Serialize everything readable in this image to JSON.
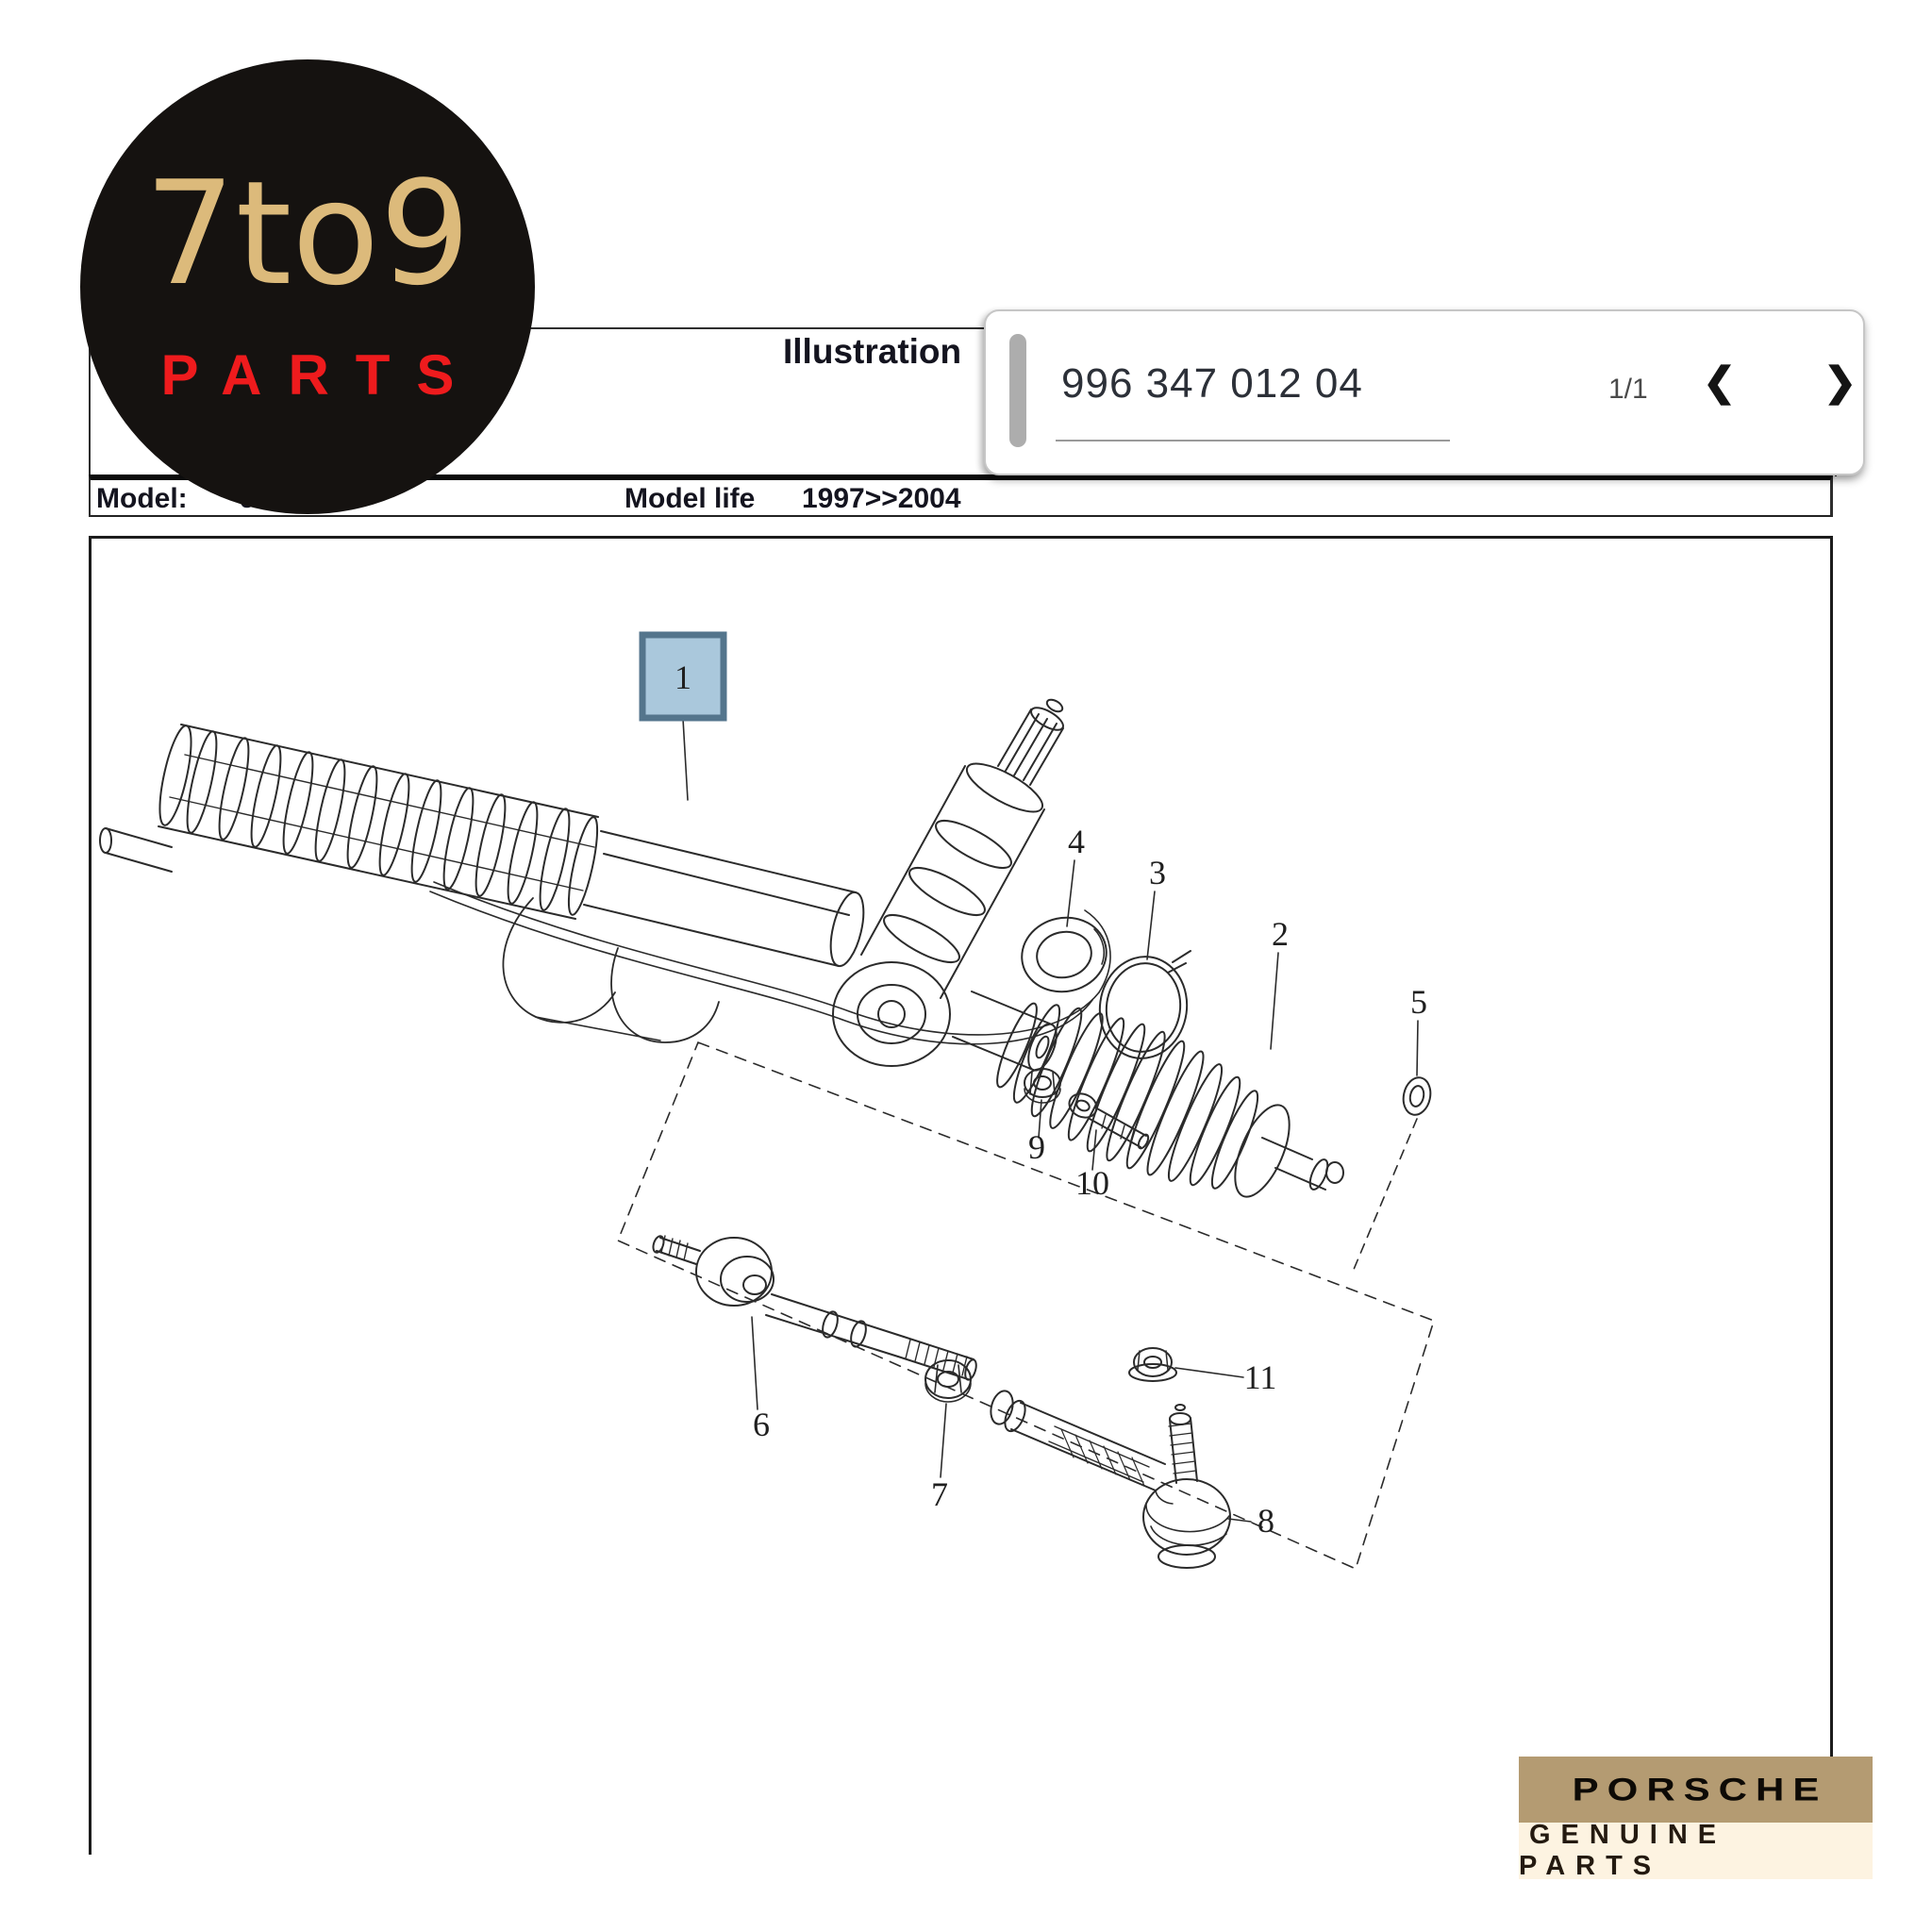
{
  "logo": {
    "line1": "7to9",
    "line2": "PARTS"
  },
  "header": {
    "title": "Illustration"
  },
  "part_navigator": {
    "part_number": "996 347 012 04",
    "page_indicator": "1/1",
    "prev_icon": "❮",
    "next_icon": "❯"
  },
  "model_row": {
    "model_label": "Model:",
    "model_value": "996 04",
    "life_label": "Model life",
    "life_value": "1997>>2004"
  },
  "diagram": {
    "highlighted_part": "1",
    "labels": {
      "l1": "1",
      "l2": "2",
      "l3": "3",
      "l4": "4",
      "l5": "5",
      "l6": "6",
      "l7": "7",
      "l8": "8",
      "l9": "9",
      "l10": "10",
      "l11": "11"
    }
  },
  "badge": {
    "brand": "PORSCHE",
    "subtitle": "GENUINE PARTS"
  },
  "colors": {
    "highlight_fill": "#aac8dc",
    "highlight_border": "#54758c",
    "logo_gold": "#dcba7b",
    "logo_red": "#ee1b1d",
    "badge_tan": "#b49b72",
    "badge_cream": "#fdf3e1",
    "line_color": "#2e2e2e"
  }
}
